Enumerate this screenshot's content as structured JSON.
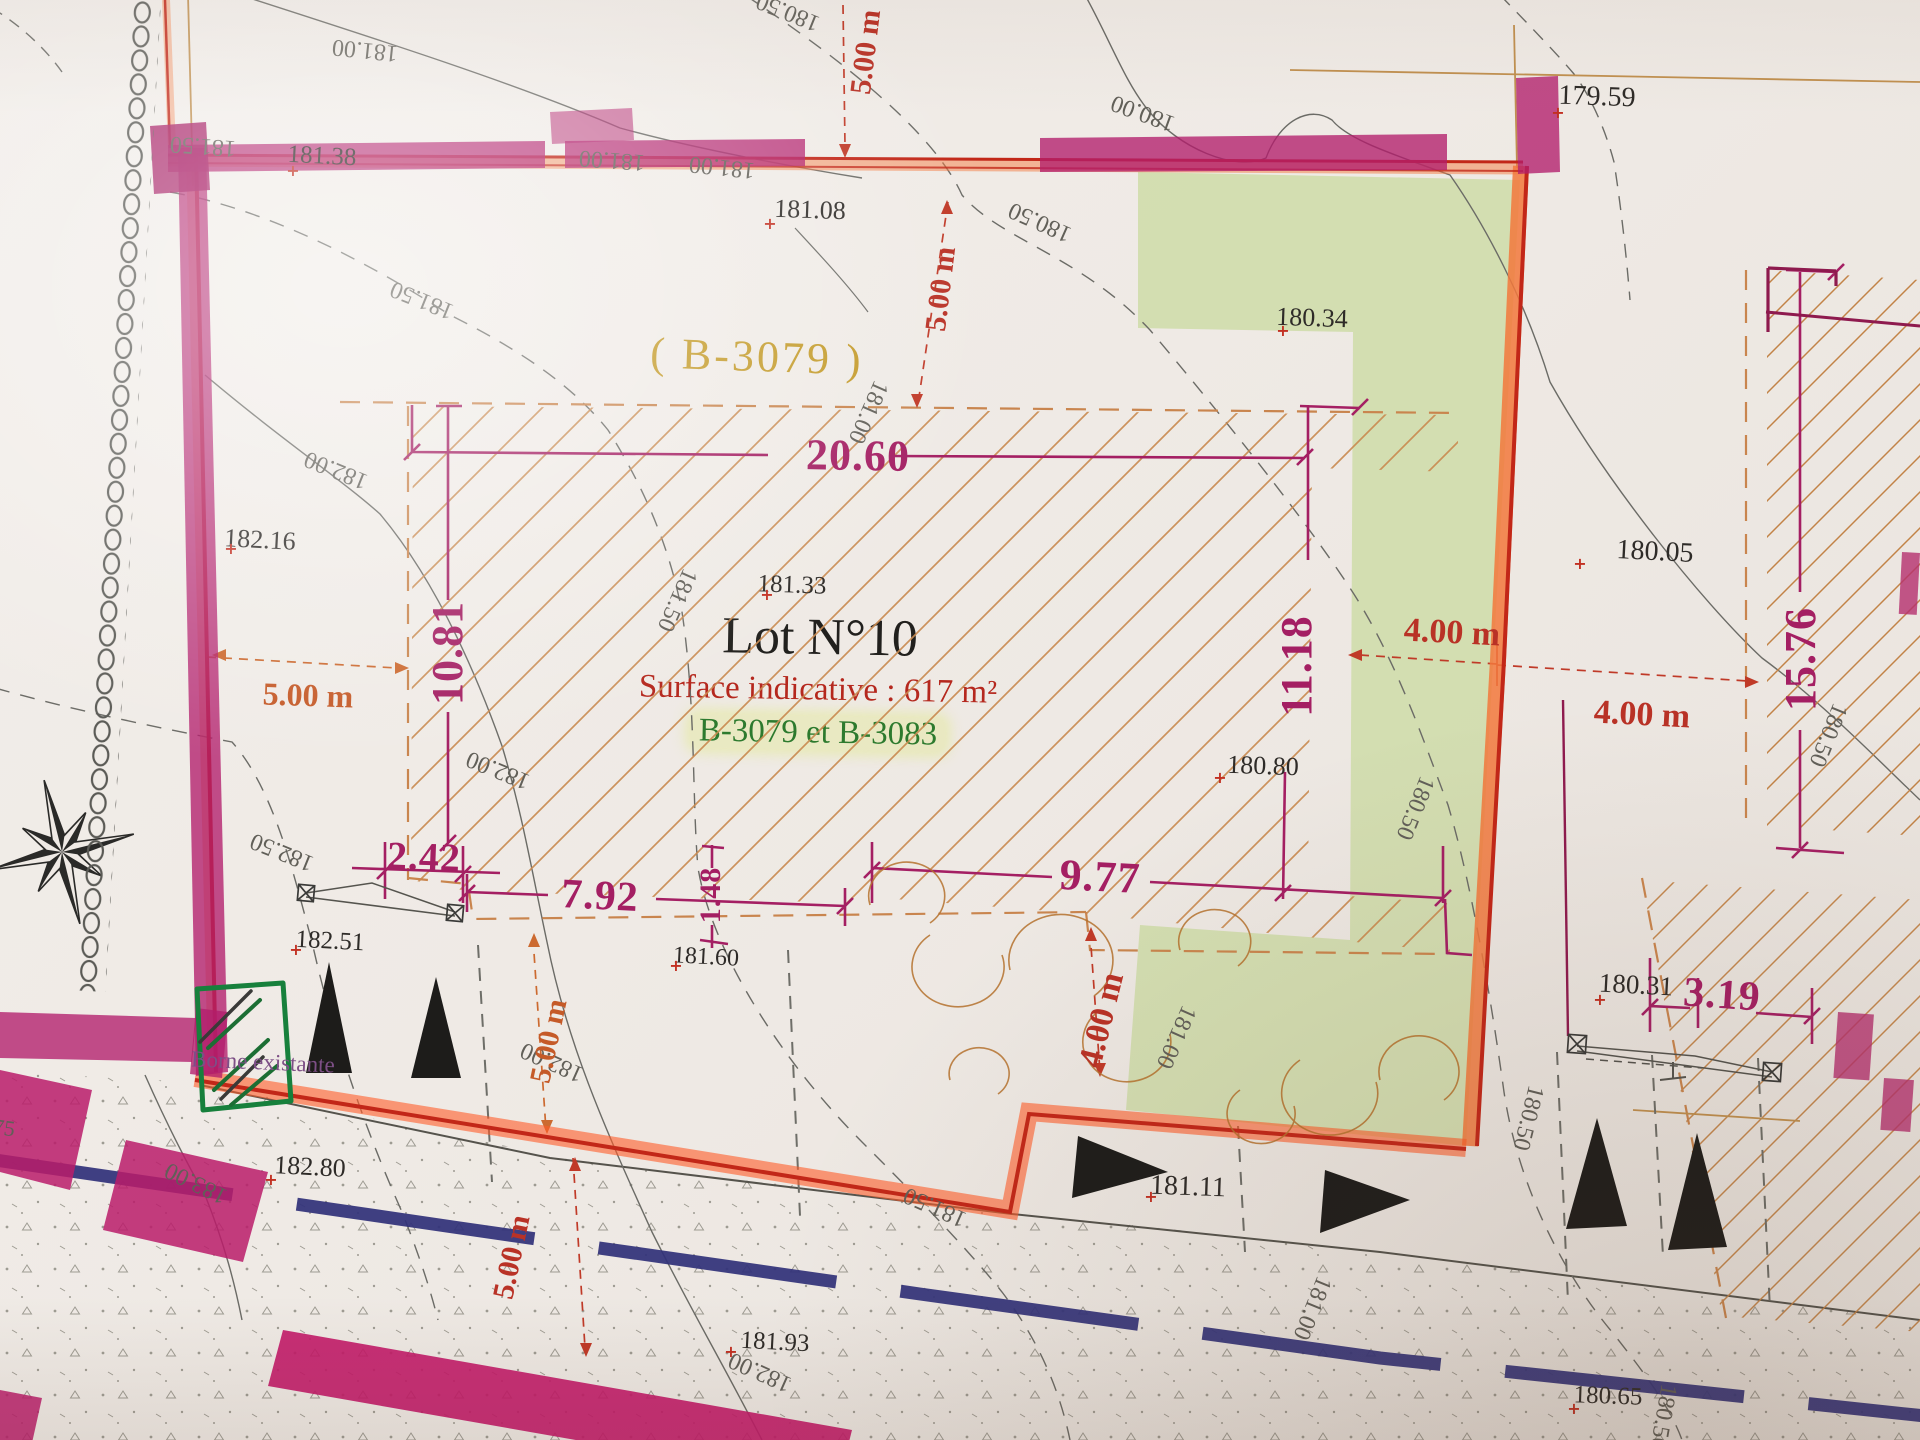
{
  "plan": {
    "lot_title": "Lot N°10",
    "surface_line": "Surface indicative : 617 m²",
    "parcels_line": "B-3079 et B-3083",
    "parcel_ref": "( B-3079 )",
    "borne_note": "Borne existante"
  },
  "colors": {
    "dim-magenta": "#a41f63",
    "dim-red": "#b93226",
    "dim-orange": "#c55a28",
    "red-note": "#b5281e",
    "parcel-green": "#2d7a2e",
    "parcel-gold": "#c49b2a",
    "borne-purple": "#7d4f86",
    "boundary-red": "#c22718",
    "highlight-magenta": "#b2246e",
    "highlight-orange": "#f07c3c",
    "green-area": "#cfdcaa",
    "road-blue": "#32327a",
    "contour-gray": "#615f58"
  },
  "points": [
    {
      "t": "181.38",
      "x": 322,
      "y": 156,
      "r": 3,
      "s": 25
    },
    {
      "t": "181.08",
      "x": 810,
      "y": 210,
      "r": 2,
      "s": 26
    },
    {
      "t": "179.59",
      "x": 1597,
      "y": 97,
      "r": 2,
      "s": 28
    },
    {
      "t": "180.34",
      "x": 1312,
      "y": 318,
      "r": 2,
      "s": 26
    },
    {
      "t": "182.16",
      "x": 260,
      "y": 540,
      "r": 3,
      "s": 26
    },
    {
      "t": "181.33",
      "x": 792,
      "y": 585,
      "r": 2,
      "s": 25
    },
    {
      "t": "180.05",
      "x": 1655,
      "y": 552,
      "r": 3,
      "s": 28
    },
    {
      "t": "180.80",
      "x": 1263,
      "y": 766,
      "r": 2,
      "s": 26
    },
    {
      "t": "182.51",
      "x": 330,
      "y": 941,
      "r": 3,
      "s": 25
    },
    {
      "t": "181.60",
      "x": 706,
      "y": 957,
      "r": 3,
      "s": 24
    },
    {
      "t": "182.80",
      "x": 310,
      "y": 1167,
      "r": 3,
      "s": 26
    },
    {
      "t": "181.11",
      "x": 1188,
      "y": 1187,
      "r": 2,
      "s": 28
    },
    {
      "t": "180.31",
      "x": 1636,
      "y": 985,
      "r": 3,
      "s": 27
    },
    {
      "t": "181.93",
      "x": 775,
      "y": 1342,
      "r": 3,
      "s": 25
    },
    {
      "t": "180.65",
      "x": 1608,
      "y": 1396,
      "r": 2,
      "s": 25
    }
  ],
  "contours": [
    {
      "t": "181.00",
      "x": 365,
      "y": 50,
      "r": 186,
      "s": 24
    },
    {
      "t": "181.00",
      "x": 612,
      "y": 160,
      "r": 184,
      "s": 24
    },
    {
      "t": "181.00",
      "x": 722,
      "y": 167,
      "r": 186,
      "s": 24
    },
    {
      "t": "180.50",
      "x": 788,
      "y": 12,
      "r": 202,
      "s": 24
    },
    {
      "t": "180.00",
      "x": 1143,
      "y": 113,
      "r": 200,
      "s": 24
    },
    {
      "t": "180.50",
      "x": 1040,
      "y": 222,
      "r": 204,
      "s": 24
    },
    {
      "t": "181.50",
      "x": 203,
      "y": 146,
      "r": 184,
      "s": 24
    },
    {
      "t": "181.50",
      "x": 422,
      "y": 300,
      "r": 202,
      "s": 24
    },
    {
      "t": "182.00",
      "x": 336,
      "y": 470,
      "r": 202,
      "s": 24
    },
    {
      "t": "182.00",
      "x": 498,
      "y": 770,
      "r": 202,
      "s": 24
    },
    {
      "t": "181.50",
      "x": 677,
      "y": 600,
      "r": 114,
      "s": 24
    },
    {
      "t": "181.00",
      "x": 868,
      "y": 412,
      "r": 114,
      "s": 24
    },
    {
      "t": "181.00",
      "x": 1176,
      "y": 1037,
      "r": 114,
      "s": 24
    },
    {
      "t": "181.00",
      "x": 1312,
      "y": 1308,
      "r": 112,
      "s": 24
    },
    {
      "t": "181.50",
      "x": 935,
      "y": 1207,
      "r": 204,
      "s": 24
    },
    {
      "t": "180.50",
      "x": 1415,
      "y": 808,
      "r": 112,
      "s": 24
    },
    {
      "t": "180.50",
      "x": 1528,
      "y": 1118,
      "r": 104,
      "s": 24
    },
    {
      "t": "180.50",
      "x": 1663,
      "y": 1417,
      "r": 100,
      "s": 24
    },
    {
      "t": "182.50",
      "x": 282,
      "y": 852,
      "r": 202,
      "s": 24
    },
    {
      "t": "183.00",
      "x": 196,
      "y": 1183,
      "r": 206,
      "s": 24
    },
    {
      "t": "182.00",
      "x": 552,
      "y": 1062,
      "r": 204,
      "s": 24
    },
    {
      "t": "182.00",
      "x": 760,
      "y": 1372,
      "r": 204,
      "s": 24
    },
    {
      "t": "180.50",
      "x": 1828,
      "y": 735,
      "r": 112,
      "s": 24
    },
    {
      "t": "75",
      "x": 4,
      "y": 1128,
      "r": 8,
      "s": 22
    }
  ],
  "dims_magenta": [
    {
      "t": "20.60",
      "x": 858,
      "y": 456,
      "r": 1,
      "s": 44
    },
    {
      "t": "10.81",
      "x": 448,
      "y": 653,
      "r": -90,
      "s": 44
    },
    {
      "t": "11.18",
      "x": 1297,
      "y": 666,
      "r": -90,
      "s": 44
    },
    {
      "t": "9.77",
      "x": 1100,
      "y": 877,
      "r": 3,
      "s": 44
    },
    {
      "t": "7.92",
      "x": 600,
      "y": 896,
      "r": 3,
      "s": 42
    },
    {
      "t": "2.42",
      "x": 424,
      "y": 857,
      "r": 2,
      "s": 40
    },
    {
      "t": "1.48",
      "x": 711,
      "y": 895,
      "r": -90,
      "s": 30
    },
    {
      "t": "15.76",
      "x": 1801,
      "y": 659,
      "r": -90,
      "s": 44
    },
    {
      "t": "3.19",
      "x": 1722,
      "y": 995,
      "r": 4,
      "s": 42
    }
  ],
  "dims_red": [
    {
      "t": "5.00 m",
      "x": 866,
      "y": 52,
      "r": -83,
      "s": 30,
      "c": "dr"
    },
    {
      "t": "5.00 m",
      "x": 941,
      "y": 289,
      "r": -83,
      "s": 30,
      "c": "dr"
    },
    {
      "t": "5.00 m",
      "x": 308,
      "y": 695,
      "r": 2,
      "s": 32,
      "c": "do"
    },
    {
      "t": "5.00 m",
      "x": 549,
      "y": 1041,
      "r": -78,
      "s": 30,
      "c": "do"
    },
    {
      "t": "5.00 m",
      "x": 512,
      "y": 1257,
      "r": -78,
      "s": 30,
      "c": "dr"
    },
    {
      "t": "4.00 m",
      "x": 1452,
      "y": 633,
      "r": 3,
      "s": 34,
      "c": "dr"
    },
    {
      "t": "4.00 m",
      "x": 1642,
      "y": 715,
      "r": 3,
      "s": 34,
      "c": "dr"
    },
    {
      "t": "4.00 m",
      "x": 1102,
      "y": 1020,
      "r": -76,
      "s": 34,
      "c": "dr"
    }
  ],
  "crosses": [
    {
      "t": "+",
      "x": 293,
      "y": 171
    },
    {
      "t": "+",
      "x": 770,
      "y": 224
    },
    {
      "t": "+",
      "x": 1558,
      "y": 113
    },
    {
      "t": "+",
      "x": 1283,
      "y": 331
    },
    {
      "t": "+",
      "x": 231,
      "y": 549
    },
    {
      "t": "+",
      "x": 767,
      "y": 595
    },
    {
      "t": "+",
      "x": 1580,
      "y": 564
    },
    {
      "t": "+",
      "x": 1220,
      "y": 778
    },
    {
      "t": "+",
      "x": 296,
      "y": 950
    },
    {
      "t": "+",
      "x": 676,
      "y": 966
    },
    {
      "t": "+",
      "x": 271,
      "y": 1180
    },
    {
      "t": "+",
      "x": 1151,
      "y": 1197
    },
    {
      "t": "+",
      "x": 1600,
      "y": 1000
    },
    {
      "t": "+",
      "x": 731,
      "y": 1352
    },
    {
      "t": "+",
      "x": 1574,
      "y": 1409
    }
  ]
}
